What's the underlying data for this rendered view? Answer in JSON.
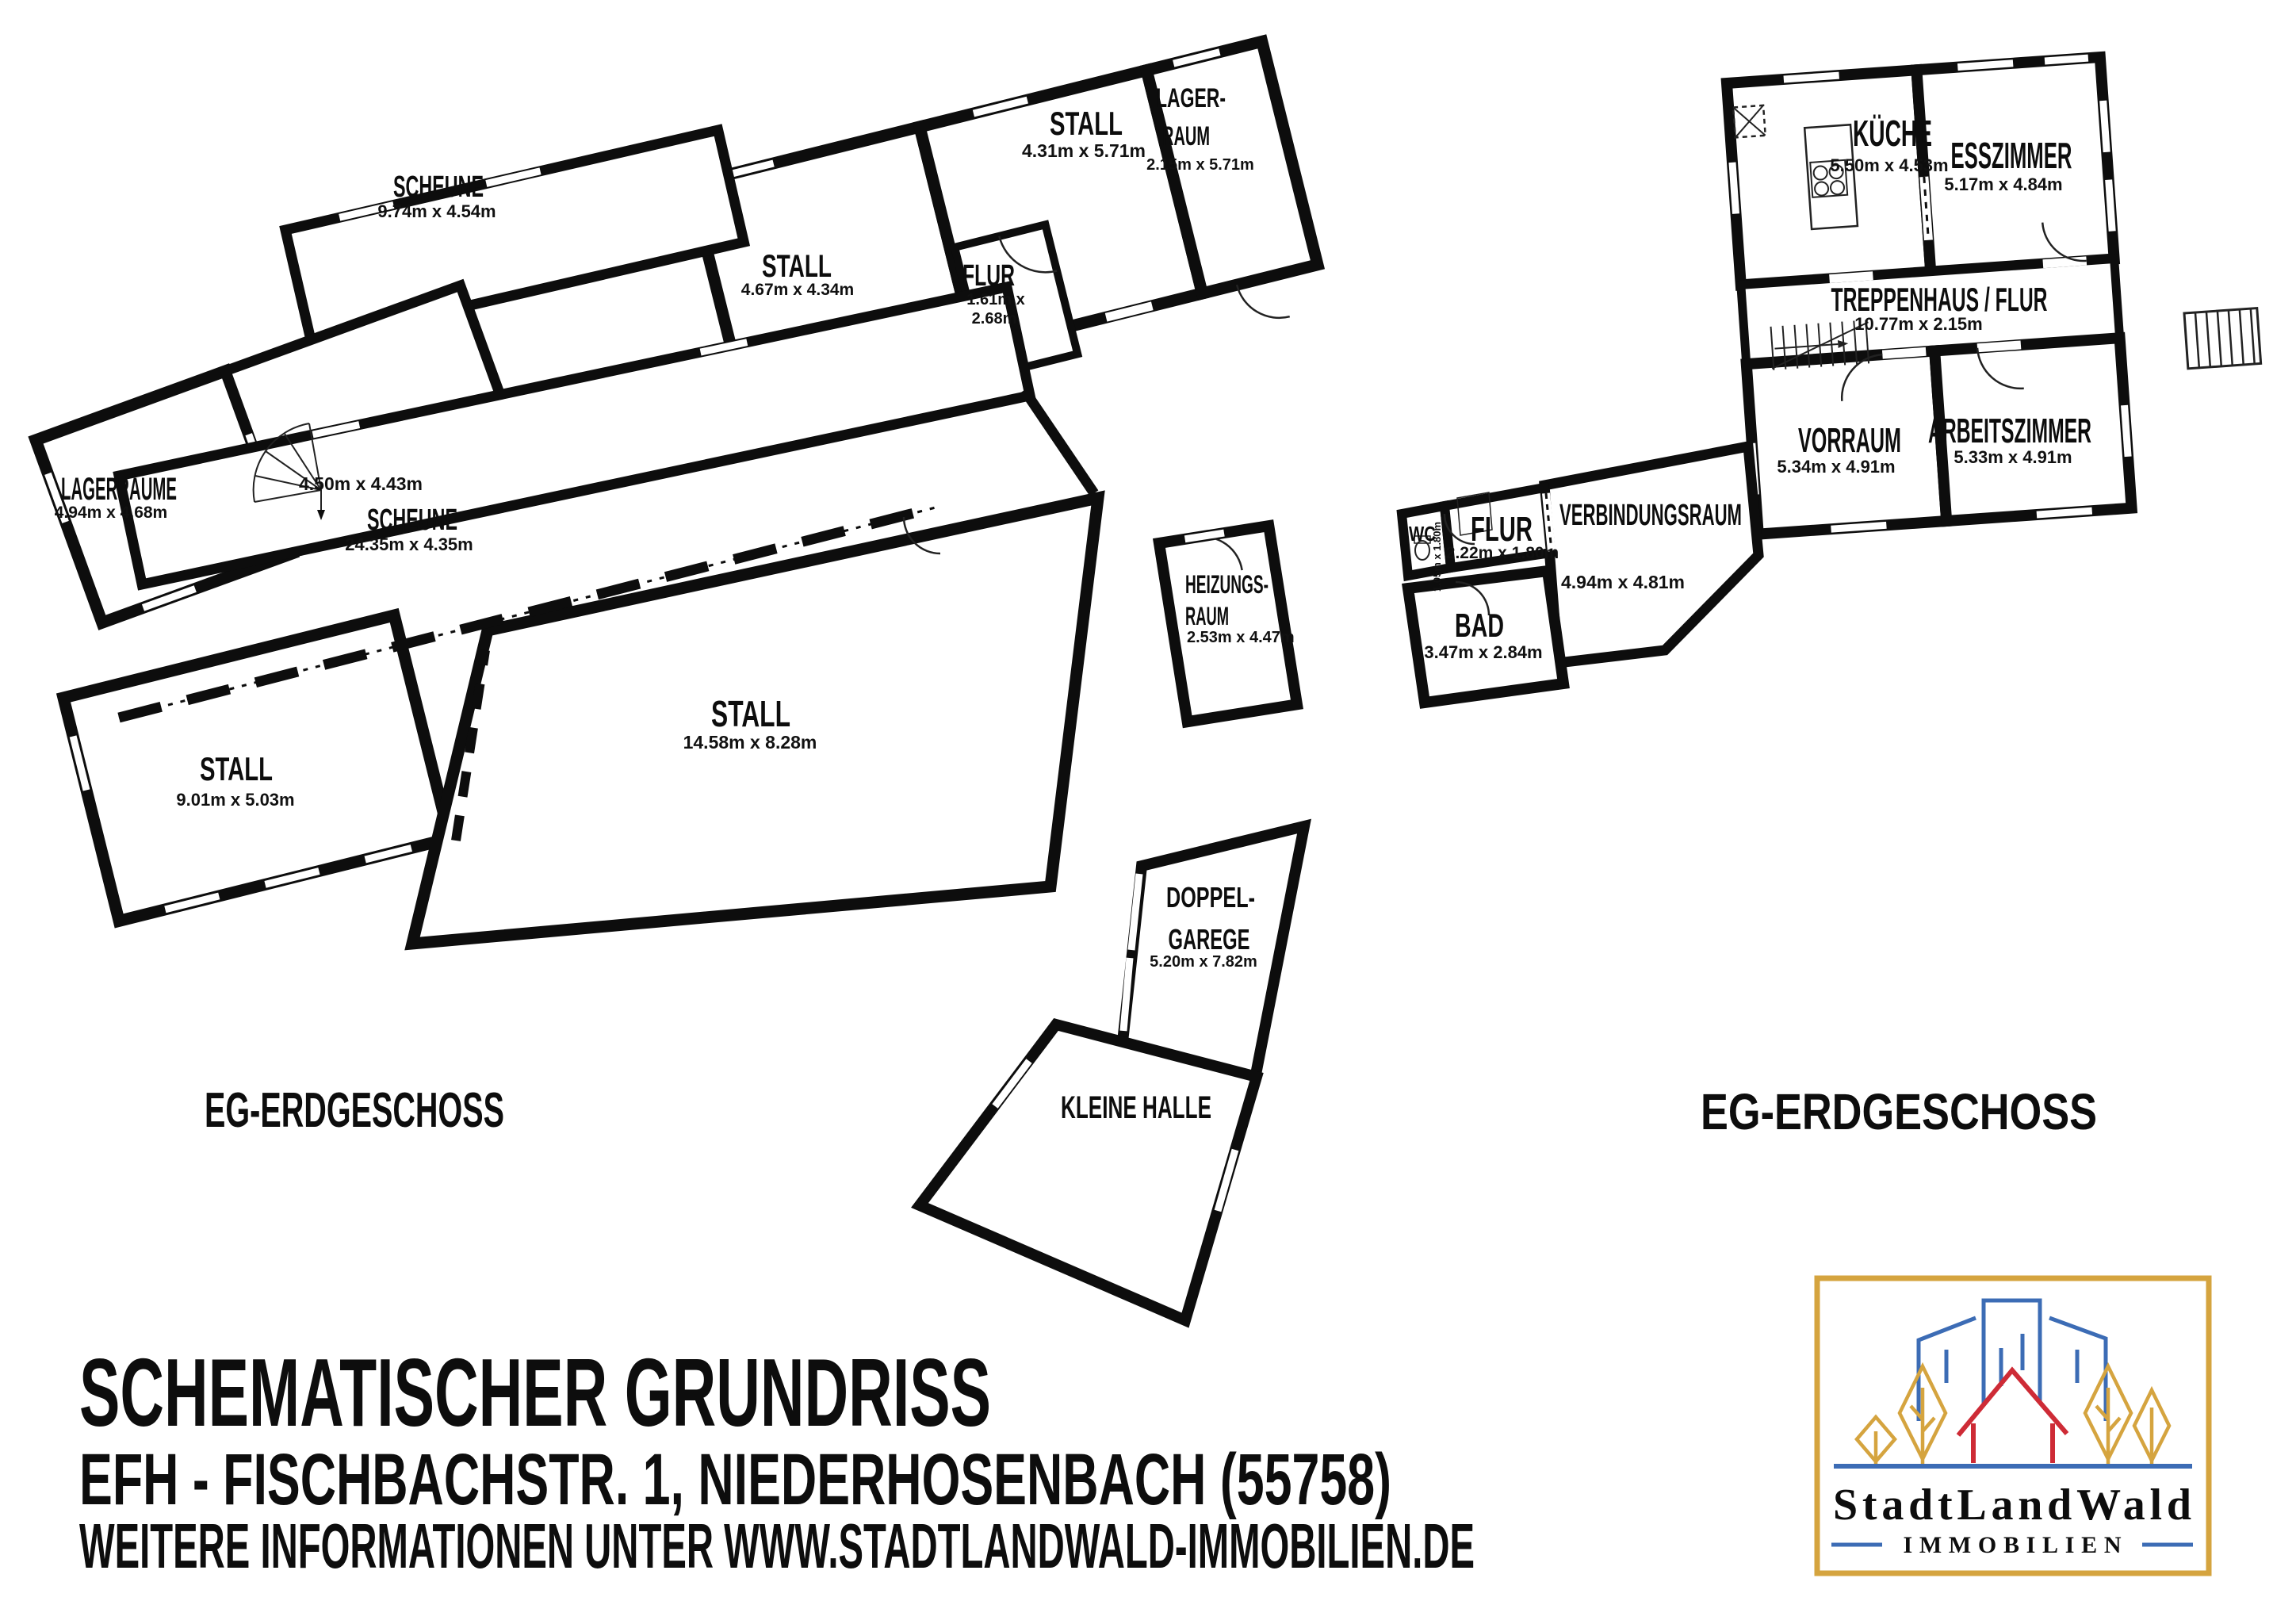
{
  "floor_labels": {
    "left": "EG-ERDGESCHOSS",
    "right": "EG-ERDGESCHOSS"
  },
  "rooms": {
    "stall_a": {
      "name": "STALL",
      "dims": "4.31m x 5.71m"
    },
    "lagerraum_a": {
      "name_line1": "LAGER-",
      "name_line2": "RAUM",
      "dims": "2.15m x 5.71m"
    },
    "stall_b": {
      "name": "STALL",
      "dims": "4.67m x 4.34m"
    },
    "flur_a": {
      "name": "FLUR",
      "dims_line1": "1.61m x",
      "dims_line2": "2.68m"
    },
    "scheune_1": {
      "name": "SCHEUNE",
      "dims": "9.74m x 4.54m"
    },
    "stair_room": {
      "dims": "4.50m x 4.43m"
    },
    "lagerraeume": {
      "name": "LAGERRÄUME",
      "dims": "4.94m x 4.68m"
    },
    "scheune_2": {
      "name": "SCHEUNE",
      "dims": "24.35m x 4.35m"
    },
    "stall_c": {
      "name": "STALL",
      "dims": "9.01m x 5.03m"
    },
    "stall_d": {
      "name": "STALL",
      "dims": "14.58m x 8.28m"
    },
    "heizungsraum": {
      "name_line1": "HEIZUNGS-",
      "name_line2": "RAUM",
      "dims": "2.53m x 4.47m"
    },
    "doppelgarage": {
      "name_line1": "DOPPEL-",
      "name_line2": "GAREGE",
      "dims": "5.20m x 7.82m"
    },
    "kleine_halle": {
      "name": "KLEINE HALLE"
    },
    "kueche": {
      "name": "KÜCHE",
      "dims": "5.50m x 4.53m"
    },
    "esszimmer": {
      "name": "ESSZIMMER",
      "dims": "5.17m x 4.84m"
    },
    "treppenhaus": {
      "name": "TREPPENHAUS / FLUR",
      "dims": "10.77m x 2.15m"
    },
    "vorraum": {
      "name": "VORRAUM",
      "dims": "5.34m x 4.91m"
    },
    "arbeitszimmer": {
      "name": "ARBEITSZIMMER",
      "dims": "5.33m x 4.91m"
    },
    "wc": {
      "name": "WC",
      "dims": "1.05m x 1.80m"
    },
    "flur_b": {
      "name": "FLUR",
      "dims": "2.22m x 1.80m"
    },
    "verbindungsraum": {
      "name": "VERBINDUNGSRAUM",
      "dims": "4.94m x 4.81m"
    },
    "bad": {
      "name": "BAD",
      "dims": "3.47m x 2.84m"
    }
  },
  "footer": {
    "title": "SCHEMATISCHER GRUNDRISS",
    "address": "EFH - FISCHBACHSTR. 1, NIEDERHOSENBACH (55758)",
    "info": "WEITERE INFORMATIONEN UNTER WWW.STADTLANDWALD-IMMOBILIEN.DE"
  },
  "logo": {
    "brand": "StadtLandWald",
    "tagline": "IMMOBILIEN",
    "colors": {
      "gold": "#D5A43F",
      "blue": "#3C6CB5",
      "red": "#CE2B36",
      "text": "#1a1a1a"
    }
  }
}
